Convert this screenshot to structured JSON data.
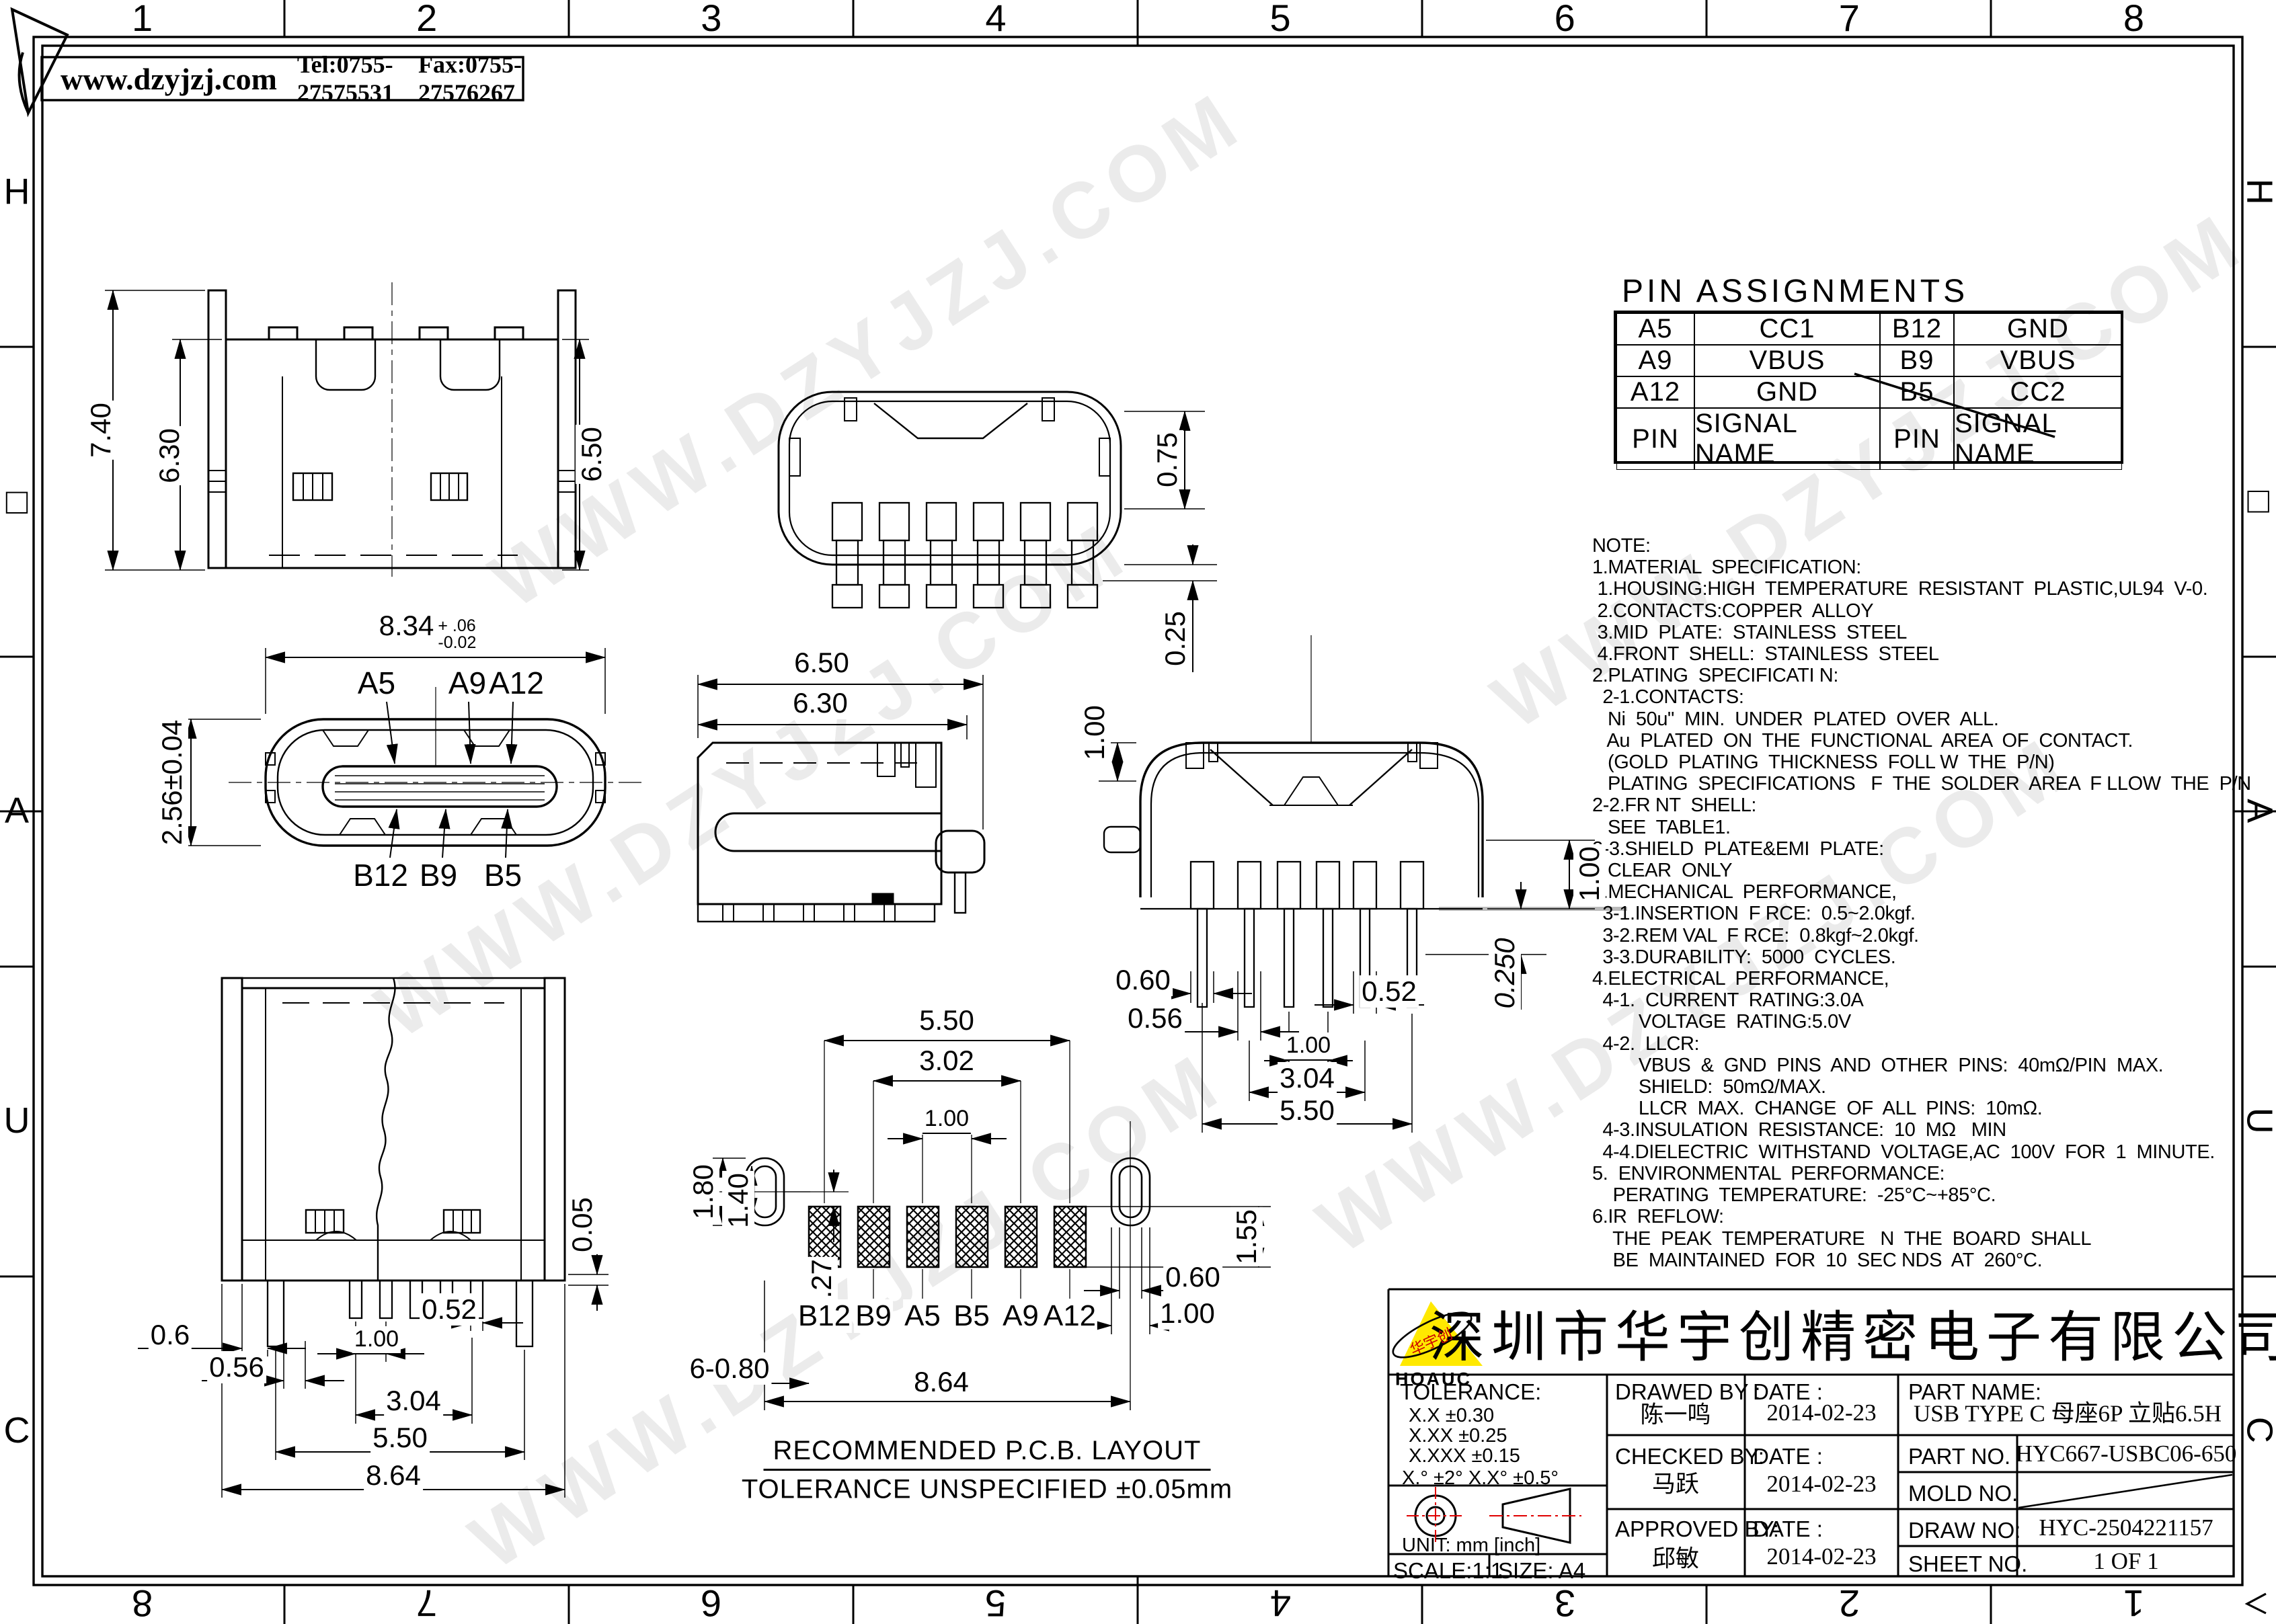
{
  "header": {
    "website": "www.dzyjzj.com",
    "tel": "Tel:0755-27575531",
    "fax": "Fax:0755-27576267"
  },
  "frame": {
    "top_numbers": [
      "1",
      "2",
      "3",
      "4",
      "5",
      "6",
      "7",
      "8"
    ],
    "bottom_numbers": [
      "8",
      "7",
      "6",
      "5",
      "4",
      "3",
      "2",
      "1"
    ],
    "left_letters": [
      "H",
      "□",
      "A",
      "U",
      "C"
    ],
    "right_letters": [
      "H",
      "□",
      "A",
      "U",
      "C"
    ]
  },
  "watermark": {
    "text": "WWW.DZYJZJ.COM"
  },
  "pin_assignments": {
    "title": "PIN  ASSIGNMENTS",
    "rows": [
      [
        "A5",
        "CC1",
        "B12",
        "GND"
      ],
      [
        "A9",
        "VBUS",
        "B9",
        "VBUS"
      ],
      [
        "A12",
        "GND",
        "B5",
        "CC2"
      ],
      [
        "PIN",
        "SIGNAL NAME",
        "PIN",
        "SIGNAL NAME"
      ]
    ]
  },
  "notes": {
    "lines": [
      "NOTE:",
      "1.MATERIAL  SPECIFICATION:",
      " 1.HOUSING:HIGH  TEMPERATURE  RESISTANT  PLASTIC,UL94  V-0.",
      " 2.CONTACTS:COPPER  ALLOY",
      " 3.MID  PLATE:  STAINLESS  STEEL",
      " 4.FRONT  SHELL:  STAINLESS  STEEL",
      "2.PLATING  SPECIFICATI N:",
      "  2-1.CONTACTS:",
      "   Ni  50u\"  MIN.  UNDER  PLATED  OVER  ALL.",
      "   Au  PLATED  ON  THE  FUNCTIONAL  AREA  OF  CONTACT.",
      "   (GOLD  PLATING  THICKNESS  FOLL W  THE  P/N)",
      "   PLATING  SPECIFICATIONS   F  THE  SOLDER  AREA  F LLOW  THE  P/N",
      "2-2.FR NT  SHELL:",
      "   SEE  TABLE1.",
      "2-3.SHIELD  PLATE&EMI  PLATE:",
      "   CLEAR  ONLY",
      "3.MECHANICAL  PERFORMANCE,",
      "  3-1.INSERTION  F RCE:  0.5~2.0kgf.",
      "  3-2.REM VAL  F RCE:  0.8kgf~2.0kgf.",
      "  3-3.DURABILITY:  5000  CYCLES.",
      "4.ELECTRICAL  PERFORMANCE,",
      "  4-1.  CURRENT  RATING:3.0A",
      "         VOLTAGE  RATING:5.0V",
      "  4-2.  LLCR:",
      "         VBUS  &  GND  PINS  AND  OTHER  PINS:  40mΩ/PIN  MAX.",
      "         SHIELD:  50mΩ/MAX.",
      "         LLCR  MAX.  CHANGE  OF  ALL  PINS:  10mΩ.",
      "  4-3.INSULATION  RESISTANCE:  10  MΩ   MIN",
      "  4-4.DIELECTRIC  WITHSTAND  VOLTAGE,AC  100V  FOR  1  MINUTE.",
      "5.  ENVIRONMENTAL  PERFORMANCE:",
      "    PERATING  TEMPERATURE:  -25°C~+85°C.",
      "6.IR  REFLOW:",
      "    THE  PEAK  TEMPERATURE   N  THE  BOARD  SHALL",
      "    BE  MAINTAINED  FOR  10  SEC NDS  AT  260°C."
    ]
  },
  "views": {
    "front_elevation": {
      "d740": "7.40",
      "d630": "6.30",
      "d650": "6.50"
    },
    "bottom_view": {
      "d075": "0.75",
      "d025": "0.25"
    },
    "face_view": {
      "dim_width": "8.34",
      "tol_up": "+ .06",
      "tol_dn": "-0.02",
      "dim_height": "2.56±0.04",
      "top_pins": [
        "A5",
        "A9",
        "A12"
      ],
      "bottom_pins": [
        "B12",
        "B9",
        "B5"
      ]
    },
    "side_view": {
      "d650": "6.50",
      "d630": "6.30"
    },
    "rear_view": {
      "d100_top": "1.00",
      "d060": "0.60",
      "d056": "0.56",
      "d052": "0.52",
      "d100_pitch": "1.00",
      "d304": "3.04",
      "d550": "5.50",
      "d0250": "0.250",
      "d100_right": "1.00"
    },
    "rear_elevation": {
      "d052": "0.52",
      "d06": "0.6",
      "d100": "1.00",
      "d056": "0.56",
      "d304": "3.04",
      "d550": "5.50",
      "d864": "8.64",
      "d005": "0.05"
    },
    "pcb_layout": {
      "d550": "5.50",
      "d302": "3.02",
      "d100": "1.00",
      "d180": "1.80",
      "d140": "1.40",
      "d027": "0.27",
      "d680": "6-0.80",
      "d155": "1.55",
      "d060": "0.60",
      "d100b": "1.00",
      "d864": "8.64",
      "pads": [
        "B12",
        "B9",
        "A5",
        "B5",
        "A9",
        "A12"
      ],
      "caption_line1": "RECOMMENDED   P.C.B.  LAYOUT",
      "caption_line2": "TOLERANCE  UNSPECIFIED  ±0.05mm"
    }
  },
  "title_block": {
    "company": "深圳市华宇创精密电子有限公司",
    "logo": {
      "text": "华宇创",
      "sub": "HOAUC"
    },
    "tolerance": {
      "label": "TOLERANCE:",
      "r1": "X.X     ±0.30",
      "r2": "X.XX    ±0.25",
      "r3": "X.XXX  ±0.15",
      "angles": "X.°  ±2°        X.X°  ±0.5°"
    },
    "unit": "UNIT:  mm  [inch]",
    "scale": "SCALE:1:1",
    "size": "SIZE:  A4",
    "drawed": {
      "label": "DRAWED  BY :",
      "name": "陈一鸣",
      "date_label": "DATE :",
      "date": "2014-02-23"
    },
    "checked": {
      "label": "CHECKED  BY:",
      "name": "马跃",
      "date_label": "DATE :",
      "date": "2014-02-23"
    },
    "approved": {
      "label": "APPROVED  BY:",
      "name": "邱敏",
      "date_label": "DATE :",
      "date": "2014-02-23"
    },
    "part_name": {
      "label": "PART  NAME:",
      "value": "USB TYPE C 母座6P 立贴6.5H"
    },
    "part_no": {
      "label": "PART  NO.",
      "value": "HYC667-USBC06-650"
    },
    "mold_no": {
      "label": "MOLD  NO."
    },
    "draw_no": {
      "label": "DRAW  NO:",
      "value": "HYC-2504221157"
    },
    "sheet_no": {
      "label": "SHEET  NO.",
      "value": "1 OF 1"
    }
  }
}
